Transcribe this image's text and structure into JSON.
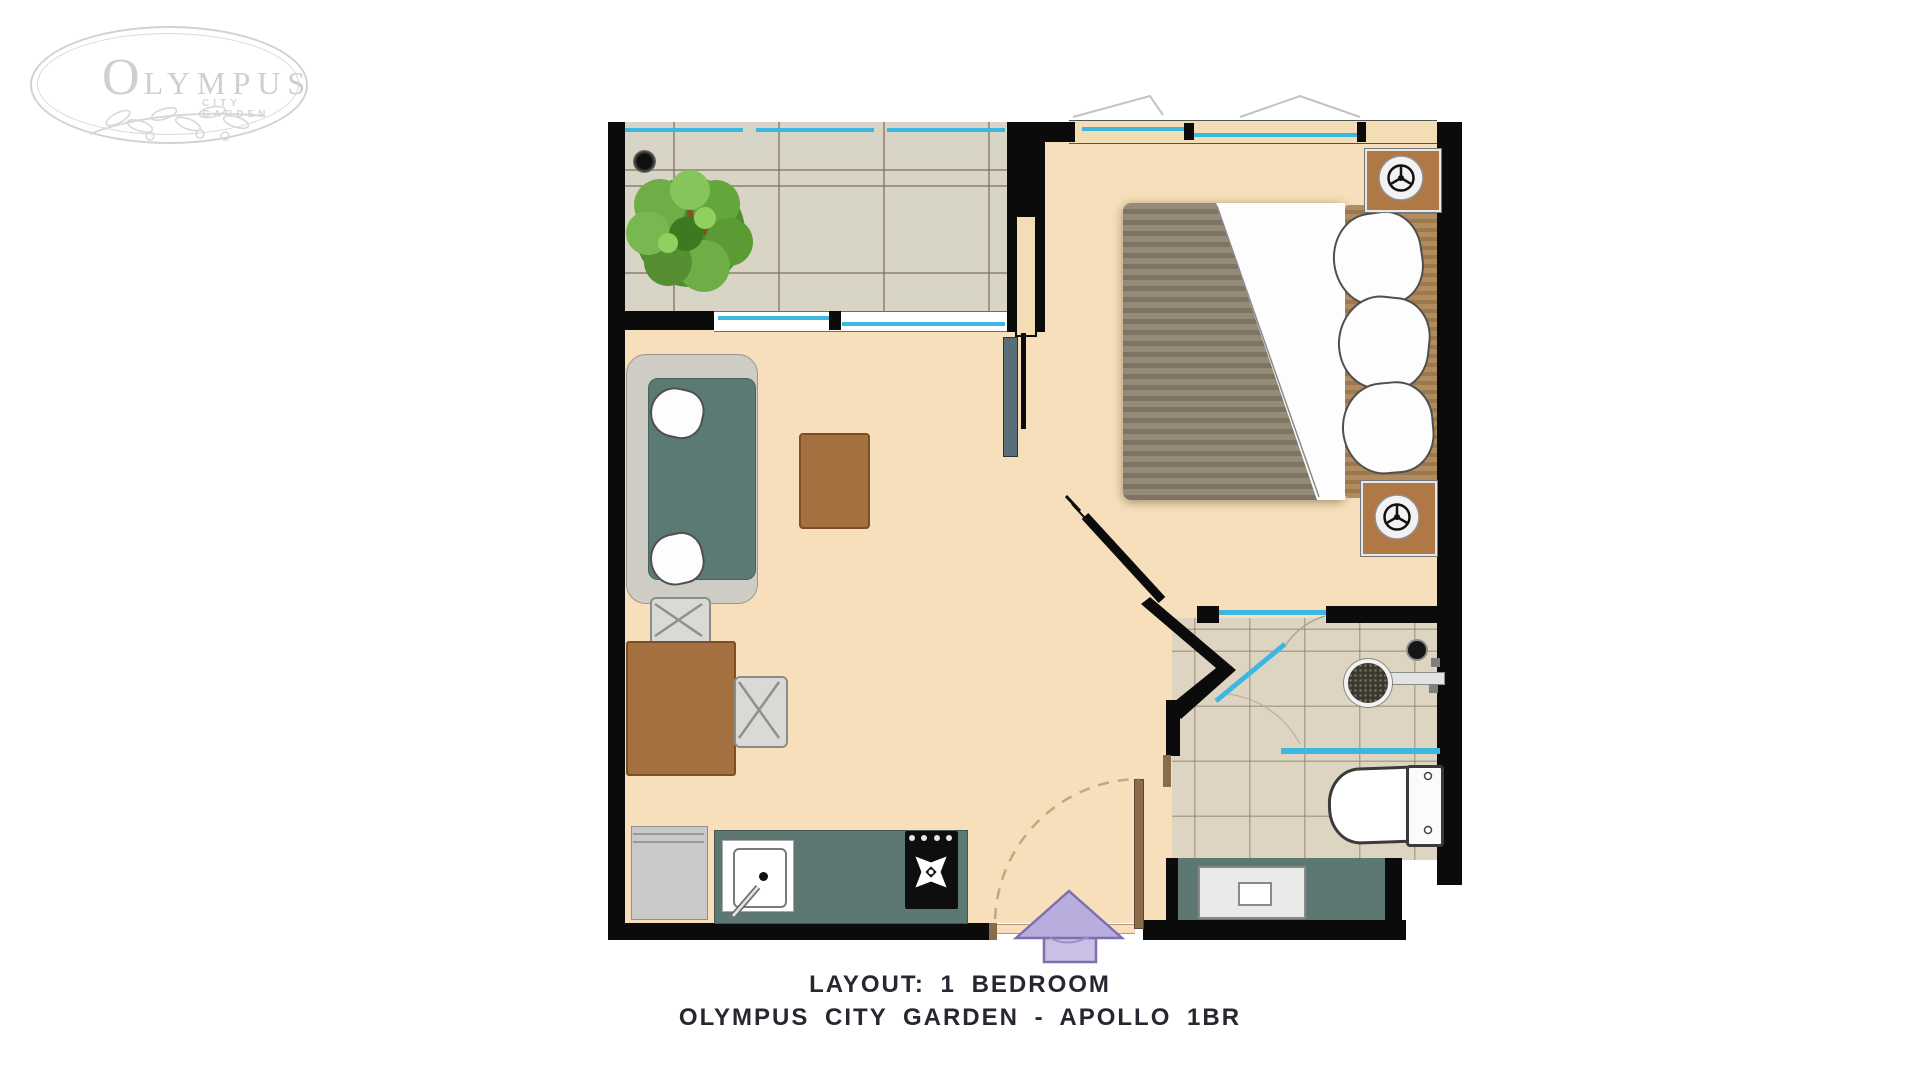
{
  "logo": {
    "initial": "O",
    "rest": "LYMPUS",
    "subtitle": "CITY GARDEN"
  },
  "caption": {
    "line1": "LAYOUT: 1 BEDROOM",
    "line2": "OLYMPUS CITY GARDEN - APOLLO 1BR"
  },
  "plan": {
    "rooms": [
      "balcony",
      "bedroom",
      "living-dining",
      "kitchen",
      "bathroom",
      "entrance-hall"
    ],
    "icons": [
      "tree-icon",
      "floor-drain-icon",
      "ac-fan-icon",
      "shower-drain-icon",
      "stove-burner-icon",
      "entry-arrow-icon"
    ],
    "colors": {
      "wall": "#0b0b0b",
      "floor_beige": "#f6dfba",
      "balcony_tile": "#d8d4c6",
      "bath_tile": "#ddd5c1",
      "glass_blue": "#3bb7e0",
      "counter_teal": "#5d7872",
      "sofa_teal": "#5c7a74",
      "wood_brown": "#a5703f",
      "ac_brown": "#b07845",
      "bed_blanket": "#8d8472",
      "headboard": "#ad8a60",
      "tv_slate": "#5a6e7a",
      "arrow_lavender": "#b9addd",
      "caption_text": "#27272f",
      "logo_gray": "#cfcfcf"
    }
  }
}
